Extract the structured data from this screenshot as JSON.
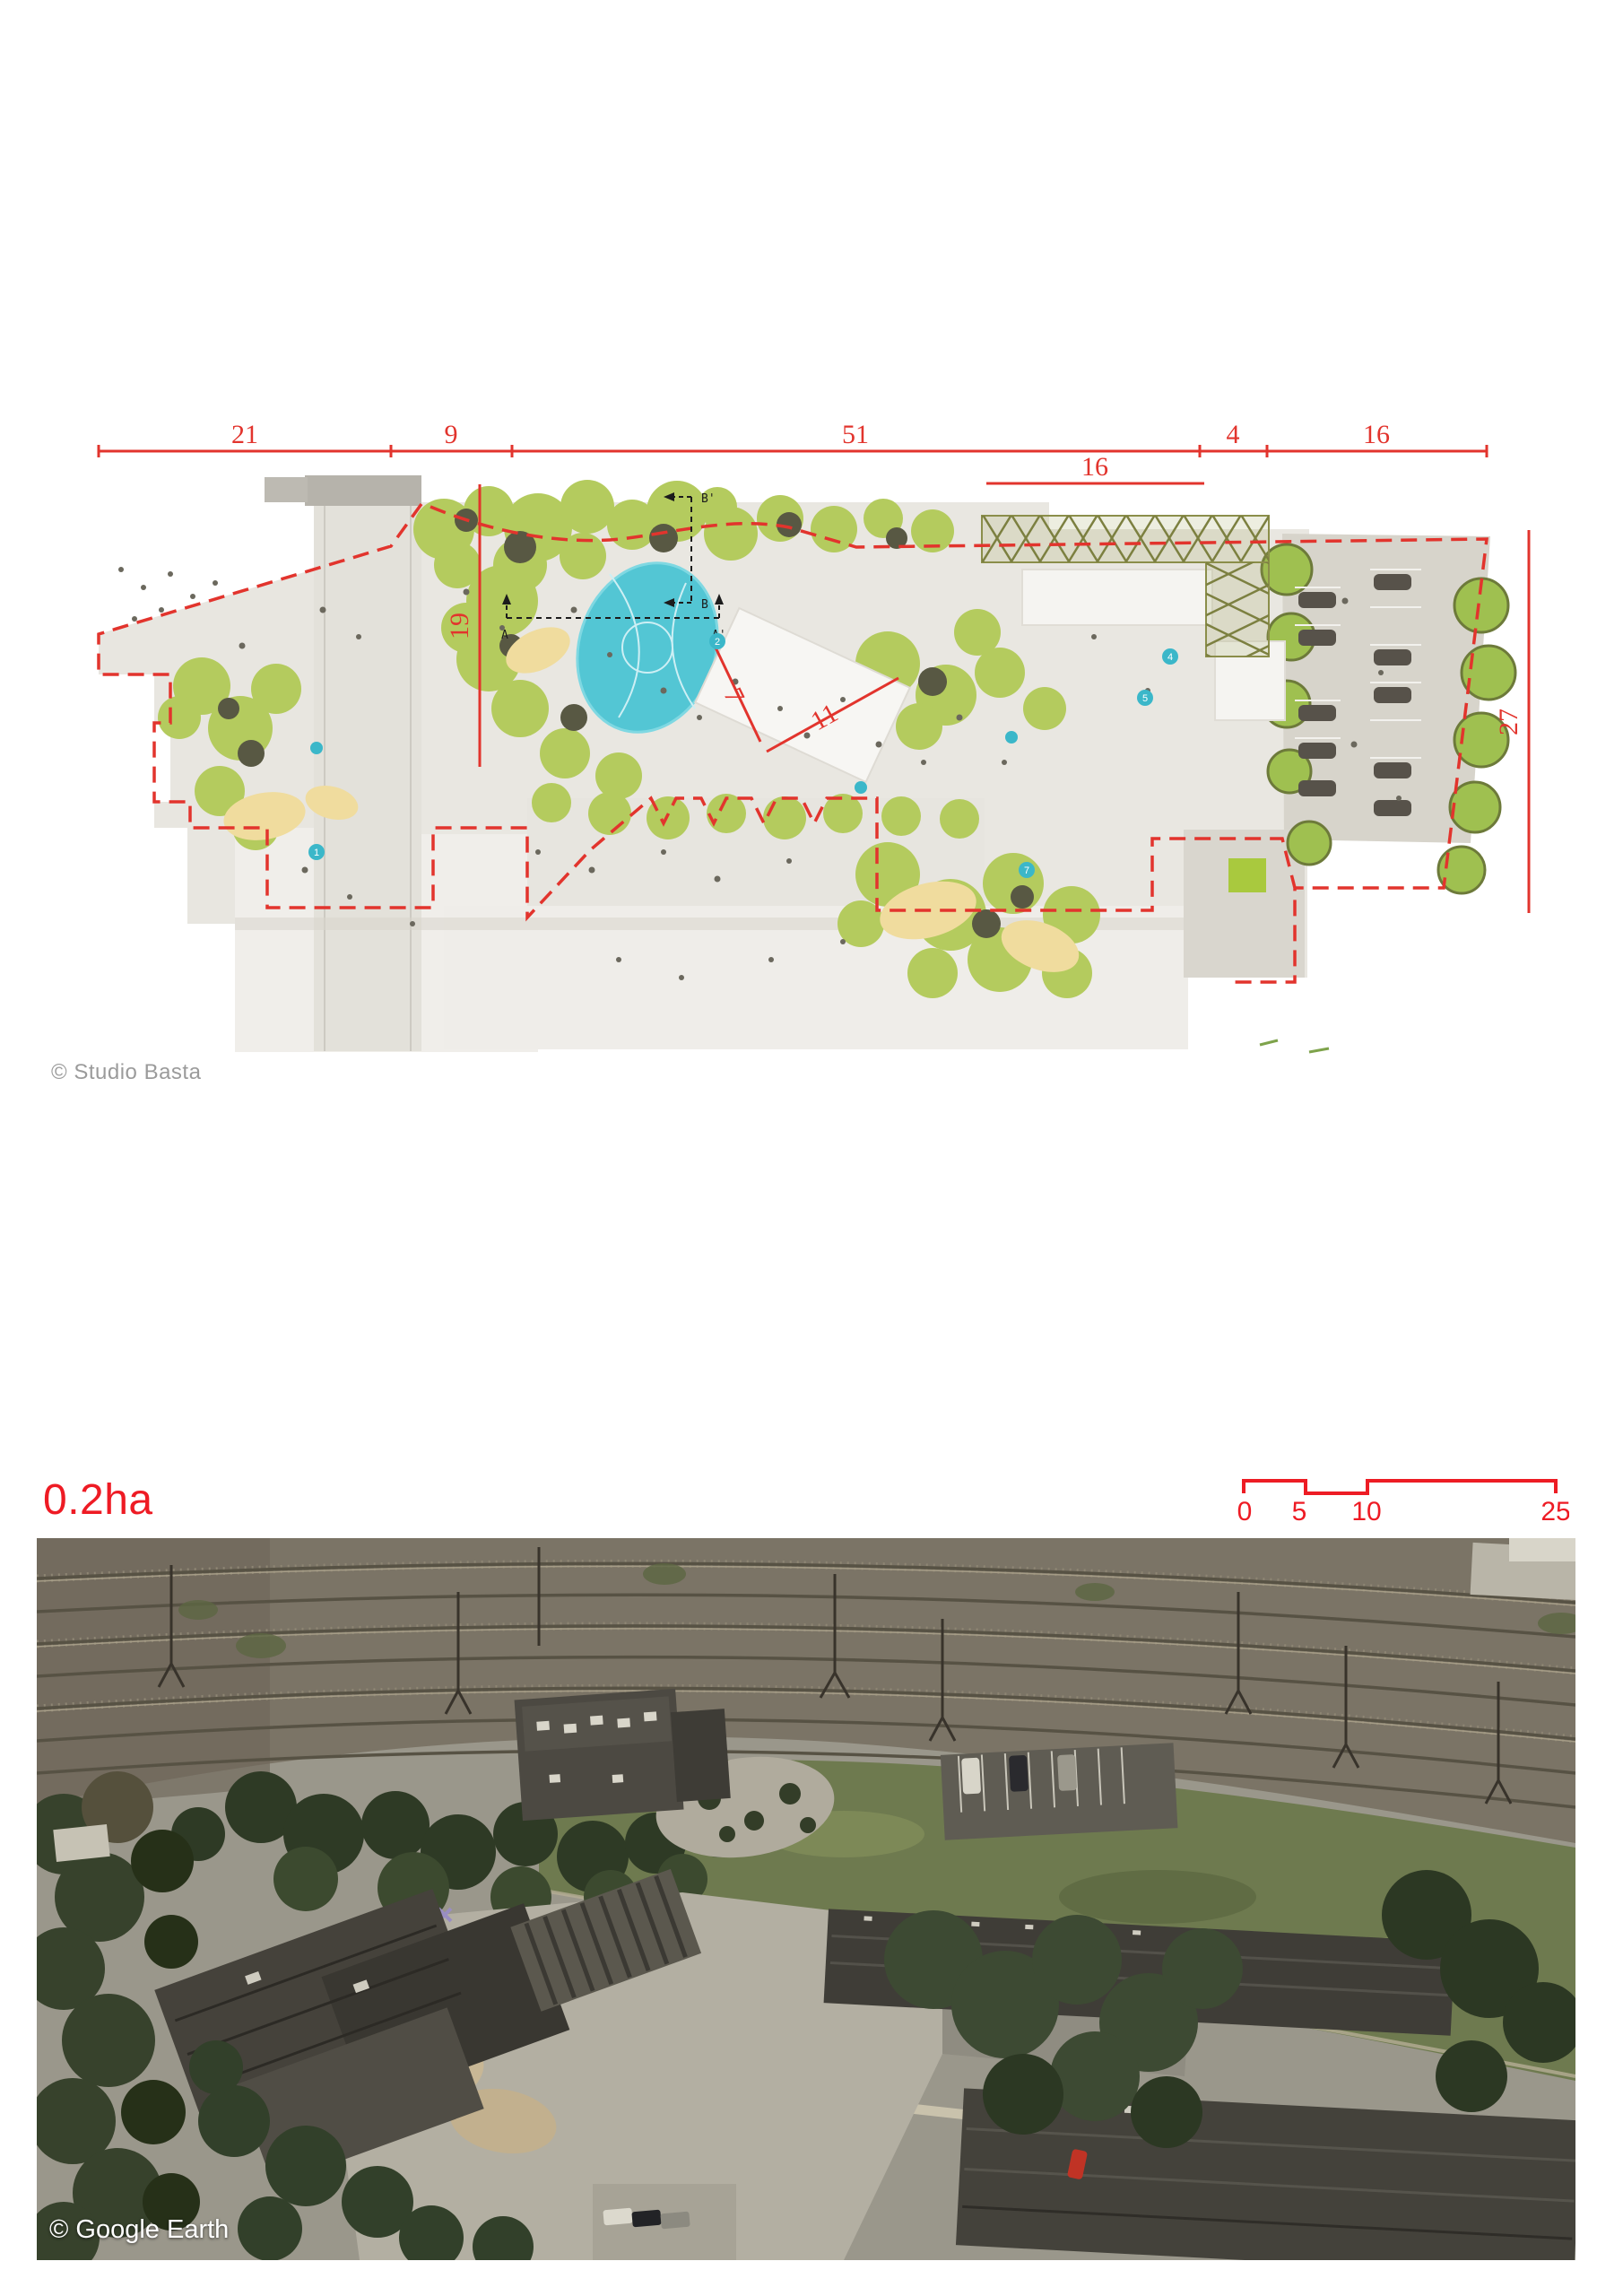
{
  "masterplan": {
    "credit": "© Studio Basta",
    "dimensions": {
      "top": [
        "21",
        "9",
        "51",
        "4",
        "16"
      ],
      "canopy_walk": "16",
      "left_height": "19",
      "right_height": "27",
      "building_width": "7",
      "building_length": "11"
    },
    "section_markers": {
      "a": "A",
      "a_prime": "A'",
      "b": "B",
      "b_prime": "B'"
    },
    "poi_markers": [
      "1",
      "2",
      "4",
      "5",
      "7"
    ],
    "colors": {
      "dimension_red": "#e2342d",
      "pond_teal": "#53c6d4",
      "canopy_green": "#b4cb5e",
      "paving_gray": "#e8e6e0"
    }
  },
  "area_label": "0.2ha",
  "scale_bar": {
    "labels": [
      "0",
      "5",
      "10",
      "25"
    ],
    "color": "#ed1c24"
  },
  "aerial": {
    "credit": "© Google Earth"
  }
}
